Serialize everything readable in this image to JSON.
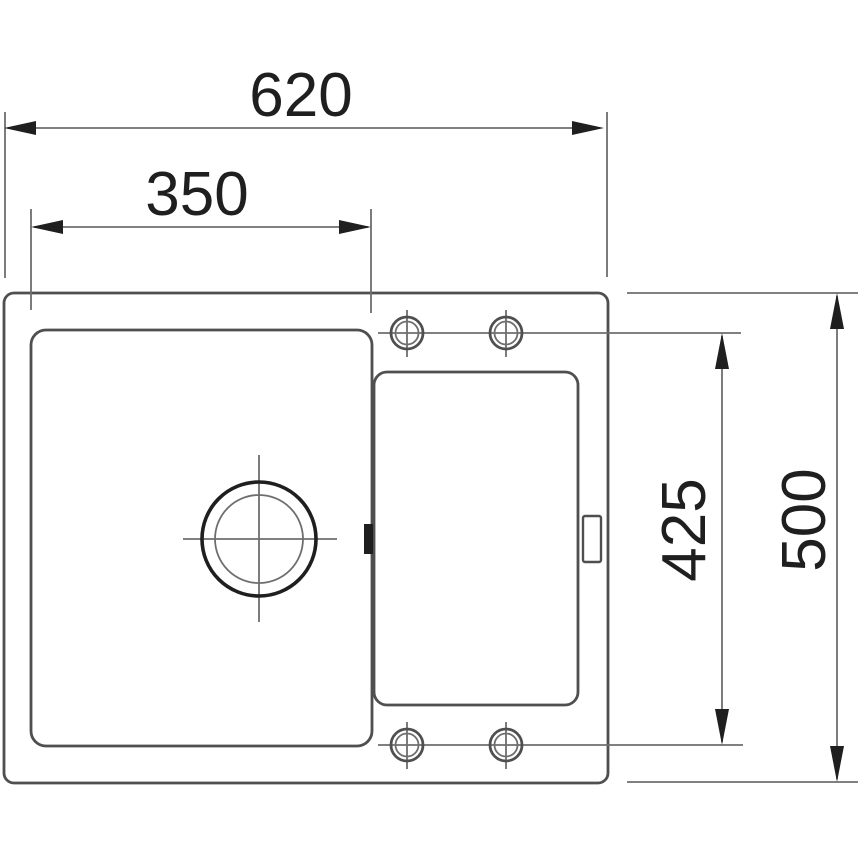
{
  "drawing": {
    "colors": {
      "line": "#4f4f4f",
      "thin_line": "#6e6e6e",
      "accent": "#1f1f1f",
      "background": "#ffffff"
    },
    "dimensions": {
      "overall_width": "620",
      "bowl_width": "350",
      "tap_hole_span": "425",
      "overall_depth": "500"
    }
  }
}
